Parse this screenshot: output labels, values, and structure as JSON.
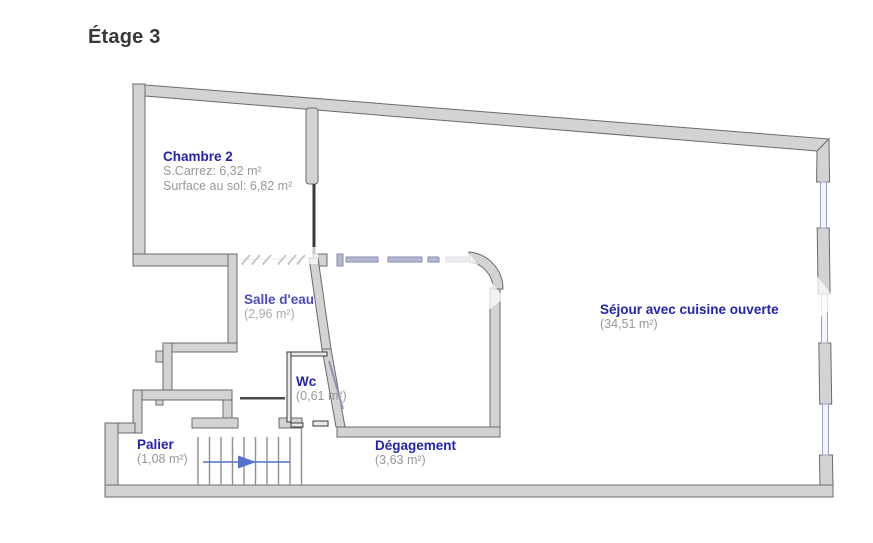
{
  "title": "Étage 3",
  "rooms": {
    "chambre2": {
      "name": "Chambre 2",
      "carrez": "S.Carrez: 6,32 m²",
      "floor": "Surface au sol: 6,82 m²"
    },
    "salle_eau": {
      "name": "Salle d'eau",
      "area": "(2,96 m²)"
    },
    "wc": {
      "name": "Wc",
      "area": "(0,61 m²)"
    },
    "sejour": {
      "name": "Séjour avec cuisine ouverte",
      "area": "(34,51 m²)"
    },
    "palier": {
      "name": "Palier",
      "area": "(1,08 m²)"
    },
    "degagement": {
      "name": "Dégagement",
      "area": "(3,63 m²)"
    }
  },
  "icons": {
    "stairs_arrow": "right-arrow (direction of stairs)"
  },
  "colors": {
    "room_label": "#2323af",
    "area_label": "#989898",
    "title": "#383838",
    "wall_fill": "#d3d3d3",
    "wall_stroke": "#6b6b6b",
    "thin_partition": "#3a3a3a",
    "window_line": "#9aa3c4",
    "dashed_line": "#b3b8d4",
    "stairs_line": "#8f8f8f",
    "arrow_blue": "#5571cc",
    "background": "#ffffff"
  }
}
